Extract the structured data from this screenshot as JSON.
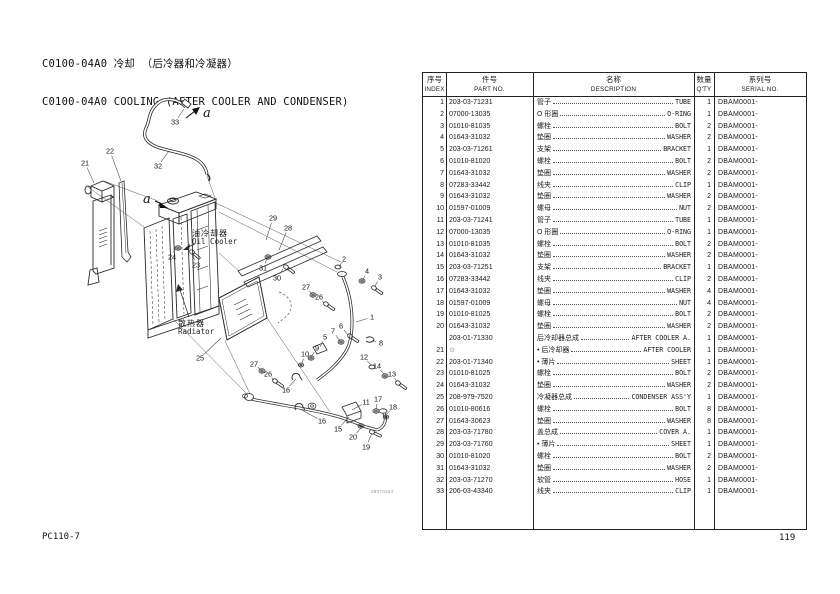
{
  "header": {
    "title_cn": "C0100-04A0 冷却 （后冷器和冷凝器）",
    "title_en": "C0100-04A0 COOLING (AFTER COOLER AND CONDENSER)"
  },
  "footer": {
    "model": "PC110-7",
    "page": "119"
  },
  "diagram": {
    "drawing_no": "09070364",
    "labels": {
      "oil_cooler_cn": "油冷却器",
      "oil_cooler_en": "Oil Cooler",
      "radiator_cn": "散热器",
      "radiator_en": "Radiator",
      "view_marker": "a"
    },
    "callouts": [
      {
        "n": "33",
        "x": 175,
        "y": 122,
        "tx": 184,
        "ty": 109
      },
      {
        "n": "32",
        "x": 158,
        "y": 166,
        "tx": 169,
        "ty": 151
      },
      {
        "n": "21",
        "x": 85,
        "y": 163,
        "tx": 94,
        "ty": 183
      },
      {
        "n": "22",
        "x": 110,
        "y": 151,
        "tx": 121,
        "ty": 181
      },
      {
        "n": "24",
        "x": 172,
        "y": 257,
        "tx": 176,
        "ty": 246
      },
      {
        "n": "23",
        "x": 196,
        "y": 265,
        "tx": 193,
        "ty": 255
      },
      {
        "n": "29",
        "x": 273,
        "y": 218,
        "tx": 266,
        "ty": 240
      },
      {
        "n": "28",
        "x": 288,
        "y": 228,
        "tx": 279,
        "ty": 250
      },
      {
        "n": "31",
        "x": 263,
        "y": 268,
        "tx": 267,
        "ty": 259
      },
      {
        "n": "30",
        "x": 277,
        "y": 278,
        "tx": 283,
        "ty": 269
      },
      {
        "n": "27",
        "x": 306,
        "y": 287,
        "tx": 312,
        "ty": 294
      },
      {
        "n": "26",
        "x": 319,
        "y": 297,
        "tx": 324,
        "ty": 303
      },
      {
        "n": "2",
        "x": 344,
        "y": 259,
        "tx": 339,
        "ty": 267
      },
      {
        "n": "4",
        "x": 367,
        "y": 271,
        "tx": 363,
        "ty": 280
      },
      {
        "n": "3",
        "x": 380,
        "y": 277,
        "tx": 375,
        "ty": 286
      },
      {
        "n": "1",
        "x": 372,
        "y": 317,
        "tx": 356,
        "ty": 322
      },
      {
        "n": "6",
        "x": 341,
        "y": 326,
        "tx": 348,
        "ty": 335
      },
      {
        "n": "7",
        "x": 333,
        "y": 331,
        "tx": 340,
        "ty": 341
      },
      {
        "n": "5",
        "x": 325,
        "y": 337,
        "tx": 320,
        "ty": 347
      },
      {
        "n": "9",
        "x": 317,
        "y": 348,
        "tx": 311,
        "ty": 357
      },
      {
        "n": "10",
        "x": 305,
        "y": 354,
        "tx": 302,
        "ty": 363
      },
      {
        "n": "8",
        "x": 381,
        "y": 343,
        "tx": 372,
        "ty": 341
      },
      {
        "n": "12",
        "x": 364,
        "y": 357,
        "tx": 371,
        "ty": 365
      },
      {
        "n": "14",
        "x": 377,
        "y": 366,
        "tx": 384,
        "ty": 374
      },
      {
        "n": "13",
        "x": 392,
        "y": 374,
        "tx": 397,
        "ty": 382
      },
      {
        "n": "27",
        "x": 254,
        "y": 364,
        "tx": 261,
        "ty": 370
      },
      {
        "n": "26",
        "x": 268,
        "y": 374,
        "tx": 274,
        "ty": 380
      },
      {
        "n": "16",
        "x": 286,
        "y": 390,
        "tx": 296,
        "ty": 379
      },
      {
        "n": "11",
        "x": 366,
        "y": 402,
        "tx": 352,
        "ty": 410
      },
      {
        "n": "17",
        "x": 378,
        "y": 399,
        "tx": 376,
        "ty": 409
      },
      {
        "n": "18",
        "x": 393,
        "y": 407,
        "tx": 386,
        "ty": 415
      },
      {
        "n": "16",
        "x": 322,
        "y": 421,
        "tx": 300,
        "ty": 409
      },
      {
        "n": "15",
        "x": 338,
        "y": 429,
        "tx": 349,
        "ty": 417
      },
      {
        "n": "20",
        "x": 353,
        "y": 437,
        "tx": 361,
        "ty": 428
      },
      {
        "n": "19",
        "x": 366,
        "y": 447,
        "tx": 372,
        "ty": 433
      },
      {
        "n": "25",
        "x": 200,
        "y": 358,
        "tx": 221,
        "ty": 338
      }
    ]
  },
  "table": {
    "columns": [
      {
        "cn": "序号",
        "en": "INDEX"
      },
      {
        "cn": "件号",
        "en": "PART NO."
      },
      {
        "cn": "名称",
        "en": "DESCRIPTION"
      },
      {
        "cn": "数量",
        "en": "Q'TY"
      },
      {
        "cn": "系列号",
        "en": "SERIAL NO."
      }
    ],
    "rows": [
      {
        "index": "1",
        "part_no": "203-03-71231",
        "desc_cn": "管子",
        "desc_en": "TUBE",
        "qty": "1",
        "serial": "DBAM0001-"
      },
      {
        "index": "2",
        "part_no": "07000-13035",
        "desc_cn": "O 形圈",
        "desc_en": "O-RING",
        "qty": "1",
        "serial": "DBAM0001-"
      },
      {
        "index": "3",
        "part_no": "01010-81035",
        "desc_cn": "螺栓",
        "desc_en": "BOLT",
        "qty": "2",
        "serial": "DBAM0001-"
      },
      {
        "index": "4",
        "part_no": "01643-31032",
        "desc_cn": "垫圈",
        "desc_en": "WASHER",
        "qty": "2",
        "serial": "DBAM0001-"
      },
      {
        "index": "5",
        "part_no": "203-03-71261",
        "desc_cn": "支架",
        "desc_en": "BRACKET",
        "qty": "1",
        "serial": "DBAM0001-"
      },
      {
        "index": "6",
        "part_no": "01010-81020",
        "desc_cn": "螺栓",
        "desc_en": "BOLT",
        "qty": "2",
        "serial": "DBAM0001-"
      },
      {
        "index": "7",
        "part_no": "01643-31032",
        "desc_cn": "垫圈",
        "desc_en": "WASHER",
        "qty": "2",
        "serial": "DBAM0001-"
      },
      {
        "index": "8",
        "part_no": "07283-33442",
        "desc_cn": "线夹",
        "desc_en": "CLIP",
        "qty": "1",
        "serial": "DBAM0001-"
      },
      {
        "index": "9",
        "part_no": "01643-31032",
        "desc_cn": "垫圈",
        "desc_en": "WASHER",
        "qty": "2",
        "serial": "DBAM0001-"
      },
      {
        "index": "10",
        "part_no": "01597-01009",
        "desc_cn": "螺母",
        "desc_en": "NUT",
        "qty": "2",
        "serial": "DBAM0001-"
      },
      {
        "index": "11",
        "part_no": "203-03-71241",
        "desc_cn": "管子",
        "desc_en": "TUBE",
        "qty": "1",
        "serial": "DBAM0001-"
      },
      {
        "index": "12",
        "part_no": "07000-13035",
        "desc_cn": "O 形圈",
        "desc_en": "O-RING",
        "qty": "1",
        "serial": "DBAM0001-"
      },
      {
        "index": "13",
        "part_no": "01010-81035",
        "desc_cn": "螺栓",
        "desc_en": "BOLT",
        "qty": "2",
        "serial": "DBAM0001-"
      },
      {
        "index": "14",
        "part_no": "01643-31032",
        "desc_cn": "垫圈",
        "desc_en": "WASHER",
        "qty": "2",
        "serial": "DBAM0001-"
      },
      {
        "index": "15",
        "part_no": "203-03-71251",
        "desc_cn": "支架",
        "desc_en": "BRACKET",
        "qty": "1",
        "serial": "DBAM0001-"
      },
      {
        "index": "16",
        "part_no": "07283-33442",
        "desc_cn": "线夹",
        "desc_en": "CLIP",
        "qty": "2",
        "serial": "DBAM0001-"
      },
      {
        "index": "17",
        "part_no": "01643-31032",
        "desc_cn": "垫圈",
        "desc_en": "WASHER",
        "qty": "4",
        "serial": "DBAM0001-"
      },
      {
        "index": "18",
        "part_no": "01597-01009",
        "desc_cn": "螺母",
        "desc_en": "NUT",
        "qty": "4",
        "serial": "DBAM0001-"
      },
      {
        "index": "19",
        "part_no": "01010-81025",
        "desc_cn": "螺栓",
        "desc_en": "BOLT",
        "qty": "2",
        "serial": "DBAM0001-"
      },
      {
        "index": "20",
        "part_no": "01643-31032",
        "desc_cn": "垫圈",
        "desc_en": "WASHER",
        "qty": "2",
        "serial": "DBAM0001-"
      },
      {
        "index": "",
        "part_no": "203-01-71330",
        "desc_cn": "后冷却器总成",
        "desc_en": "AFTER COOLER A.",
        "qty": "1",
        "serial": "DBAM0001-"
      },
      {
        "index": "21",
        "part_no": "☆",
        "desc_cn": "• 后冷却器",
        "desc_en": "AFTER COOLER",
        "qty": "1",
        "serial": "DBAM0001-"
      },
      {
        "index": "22",
        "part_no": "203-01-71340",
        "desc_cn": "• 薄片",
        "desc_en": "SHEET",
        "qty": "1",
        "serial": "DBAM0001-"
      },
      {
        "index": "23",
        "part_no": "01010-81025",
        "desc_cn": "螺栓",
        "desc_en": "BOLT",
        "qty": "2",
        "serial": "DBAM0001-"
      },
      {
        "index": "24",
        "part_no": "01643-31032",
        "desc_cn": "垫圈",
        "desc_en": "WASHER",
        "qty": "2",
        "serial": "DBAM0001-"
      },
      {
        "index": "25",
        "part_no": "208-979-7520",
        "desc_cn": "冷凝器总成",
        "desc_en": "CONDENSER ASS'Y",
        "qty": "1",
        "serial": "DBAM0001-"
      },
      {
        "index": "26",
        "part_no": "01010-80616",
        "desc_cn": "螺栓",
        "desc_en": "BOLT",
        "qty": "8",
        "serial": "DBAM0001-"
      },
      {
        "index": "27",
        "part_no": "01643-30623",
        "desc_cn": "垫圈",
        "desc_en": "WASHER",
        "qty": "8",
        "serial": "DBAM0001-"
      },
      {
        "index": "28",
        "part_no": "203-03-71780",
        "desc_cn": "盖总成",
        "desc_en": "COVER A.",
        "qty": "1",
        "serial": "DBAM0001-"
      },
      {
        "index": "29",
        "part_no": "203-03-71760",
        "desc_cn": "• 薄片",
        "desc_en": "SHEET",
        "qty": "1",
        "serial": "DBAM0001-"
      },
      {
        "index": "30",
        "part_no": "01010-81020",
        "desc_cn": "螺栓",
        "desc_en": "BOLT",
        "qty": "2",
        "serial": "DBAM0001-"
      },
      {
        "index": "31",
        "part_no": "01643-31032",
        "desc_cn": "垫圈",
        "desc_en": "WASHER",
        "qty": "2",
        "serial": "DBAM0001-"
      },
      {
        "index": "32",
        "part_no": "203-03-71270",
        "desc_cn": "软管",
        "desc_en": "HOSE",
        "qty": "1",
        "serial": "DBAM0001-"
      },
      {
        "index": "33",
        "part_no": "206-03-43340",
        "desc_cn": "线夹",
        "desc_en": "CLIP",
        "qty": "1",
        "serial": "DBAM0001-"
      }
    ]
  }
}
